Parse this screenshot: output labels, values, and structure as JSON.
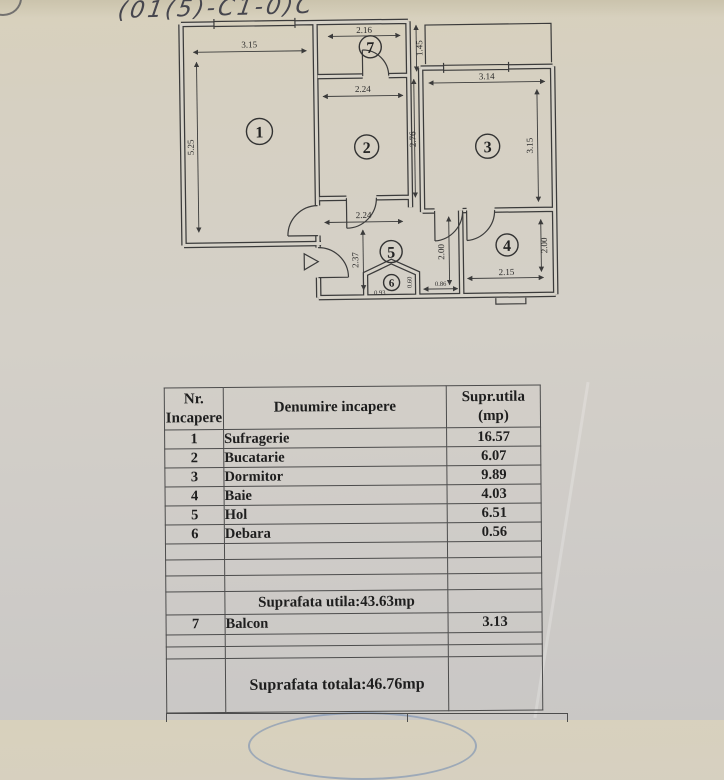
{
  "annotation": {
    "handwriting": "(01(5)-C1-0)C"
  },
  "plan": {
    "room_labels": [
      "1",
      "2",
      "3",
      "4",
      "5",
      "6",
      "7"
    ],
    "dims": {
      "living_width": "3.15",
      "living_height": "5.25",
      "balcony_width": "2.16",
      "balcony_height": "1.45",
      "kitchen_width": "2.24",
      "kitchen_height": "2.76",
      "bedroom_width": "3.14",
      "bedroom_height": "3.15",
      "hall_width": "2.24",
      "hall_height": "2.37",
      "pantry_width": "0.93",
      "pantry_height": "0.60",
      "corridor_height": "2.00",
      "corridor_gap": "0.86",
      "bath_width": "2.15",
      "bath_height": "2.00"
    }
  },
  "table": {
    "header": {
      "col1": "Nr.\nIncapere",
      "col2": "Denumire incapere",
      "col3": "Supr.utila\n(mp)"
    },
    "rows": [
      {
        "nr": "1",
        "name": "Sufragerie",
        "area": "16.57"
      },
      {
        "nr": "2",
        "name": "Bucatarie",
        "area": "6.07"
      },
      {
        "nr": "3",
        "name": "Dormitor",
        "area": "9.89"
      },
      {
        "nr": "4",
        "name": "Baie",
        "area": "4.03"
      },
      {
        "nr": "5",
        "name": "Hol",
        "area": "6.51"
      },
      {
        "nr": "6",
        "name": "Debara",
        "area": "0.56"
      }
    ],
    "subtotal_label": "Suprafata utila:43.63mp",
    "balcony_row": {
      "nr": "7",
      "name": "Balcon",
      "area": "3.13"
    },
    "total_label": "Suprafata totala:46.76mp"
  }
}
